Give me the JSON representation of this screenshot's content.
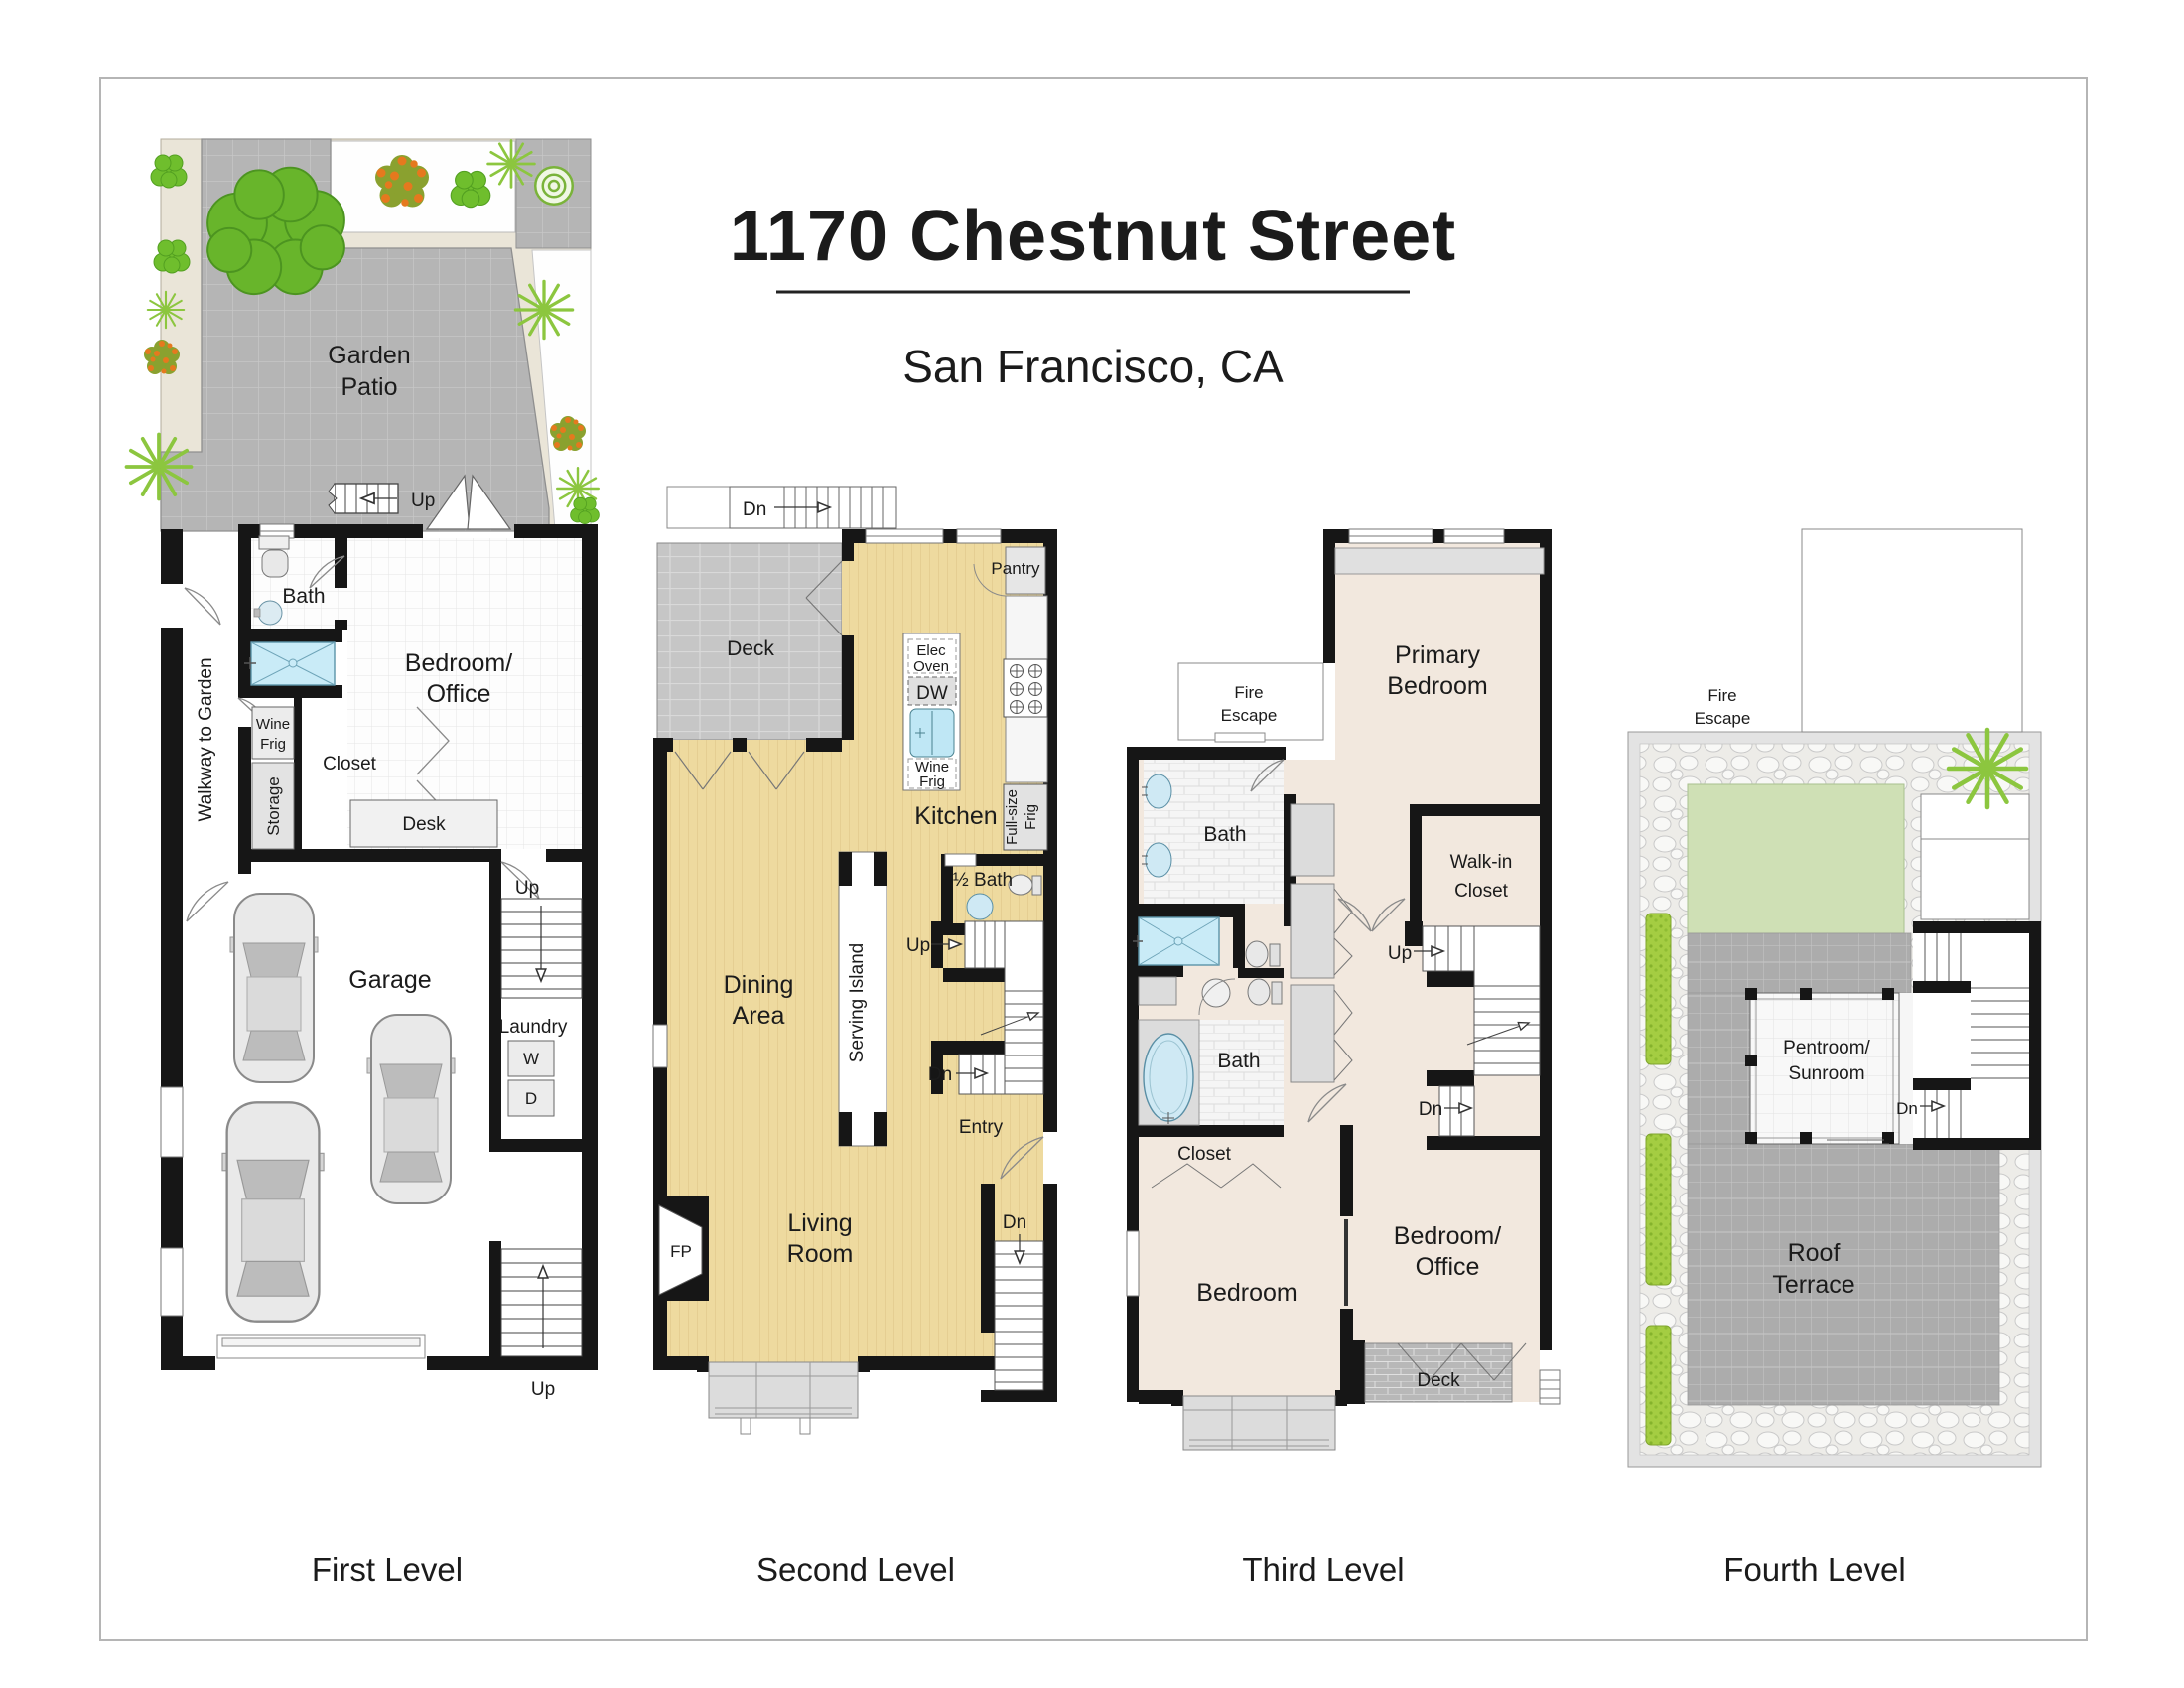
{
  "header": {
    "title": "1170 Chestnut Street",
    "subtitle": "San Francisco, CA"
  },
  "captions": {
    "first": "First Level",
    "second": "Second Level",
    "third": "Third Level",
    "fourth": "Fourth Level"
  },
  "first": {
    "garden1": "Garden",
    "garden2": "Patio",
    "up_patio": "Up",
    "bath": "Bath",
    "walkway": "Walkway to Garden",
    "bedroom1": "Bedroom/",
    "bedroom2": "Office",
    "wine1": "Wine",
    "wine2": "Frig",
    "closet": "Closet",
    "storage": "Storage",
    "desk": "Desk",
    "up_mid": "Up",
    "garage": "Garage",
    "laundry": "Laundry",
    "washer": "W",
    "dryer": "D",
    "up_bottom": "Up"
  },
  "second": {
    "dn_top": "Dn",
    "deck": "Deck",
    "pantry": "Pantry",
    "elec1": "Elec",
    "elec2": "Oven",
    "dw": "DW",
    "wine1": "Wine",
    "wine2": "Frig",
    "kitchen": "Kitchen",
    "frig1": "Full-size",
    "frig2": "Frig",
    "half_bath": "½ Bath",
    "up": "Up",
    "dn_mid": "Dn",
    "dining1": "Dining",
    "dining2": "Area",
    "serving": "Serving Island",
    "entry": "Entry",
    "dn_entry": "Dn",
    "living1": "Living",
    "living2": "Room",
    "fp": "FP"
  },
  "third": {
    "fire1": "Fire",
    "fire2": "Escape",
    "primary1": "Primary",
    "primary2": "Bedroom",
    "bath_upper": "Bath",
    "walkin1": "Walk-in",
    "walkin2": "Closet",
    "up": "Up",
    "dn": "Dn",
    "bath_lower": "Bath",
    "closet": "Closet",
    "bedroom": "Bedroom",
    "bedoffice1": "Bedroom/",
    "bedoffice2": "Office",
    "deck": "Deck"
  },
  "fourth": {
    "fire1": "Fire",
    "fire2": "Escape",
    "pentroom1": "Pentroom/",
    "pentroom2": "Sunroom",
    "dn": "Dn",
    "roof1": "Roof",
    "roof2": "Terrace"
  },
  "colors": {
    "wall": "#161616",
    "patio_gray": "#b5b5b5",
    "deck_gray": "#c6c6c6",
    "terrace_gray": "#acacac",
    "wood": "#eeda9f",
    "bedroom_beige": "#f2e8de",
    "water_blue": "#c9ebf7",
    "lawn_green": "#cfe0b5",
    "hedge_green": "#a4cd42",
    "plant_green": "#6fbe2d",
    "flower_orange": "#e5791e",
    "bed_beige": "#eae5d8"
  }
}
